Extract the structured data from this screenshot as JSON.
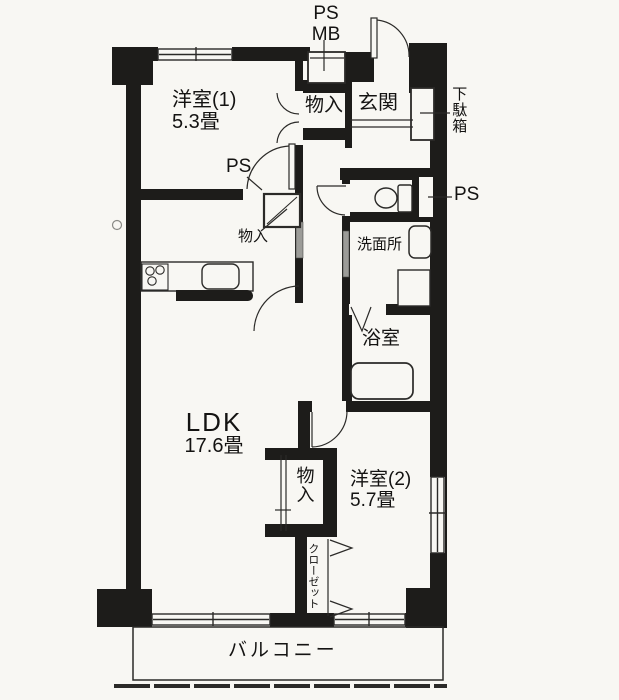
{
  "plan": {
    "title_hint": "apartment floor plan",
    "labels": {
      "ps_top": "PS",
      "mb_top": "MB",
      "room1_name": "洋室(1)",
      "room1_size": "5.3畳",
      "storage_top": "物入",
      "entrance": "玄関",
      "shoe_cabinet": "下駄箱",
      "ps_room1": "PS",
      "ps_right": "PS",
      "hallway_storage": "物入",
      "washroom": "洗面所",
      "bathroom": "浴室",
      "ldk_name": "LDK",
      "ldk_size": "17.6畳",
      "storage_center": "物入",
      "room2_name": "洋室(2)",
      "room2_size": "5.7畳",
      "closet": "クローゼット",
      "balcony": "バルコニー"
    },
    "colors": {
      "wall": "#1d1c1a",
      "paper": "#f8f7f3",
      "line": "#2b2a28",
      "slider_gray": "#9c9c98"
    }
  }
}
